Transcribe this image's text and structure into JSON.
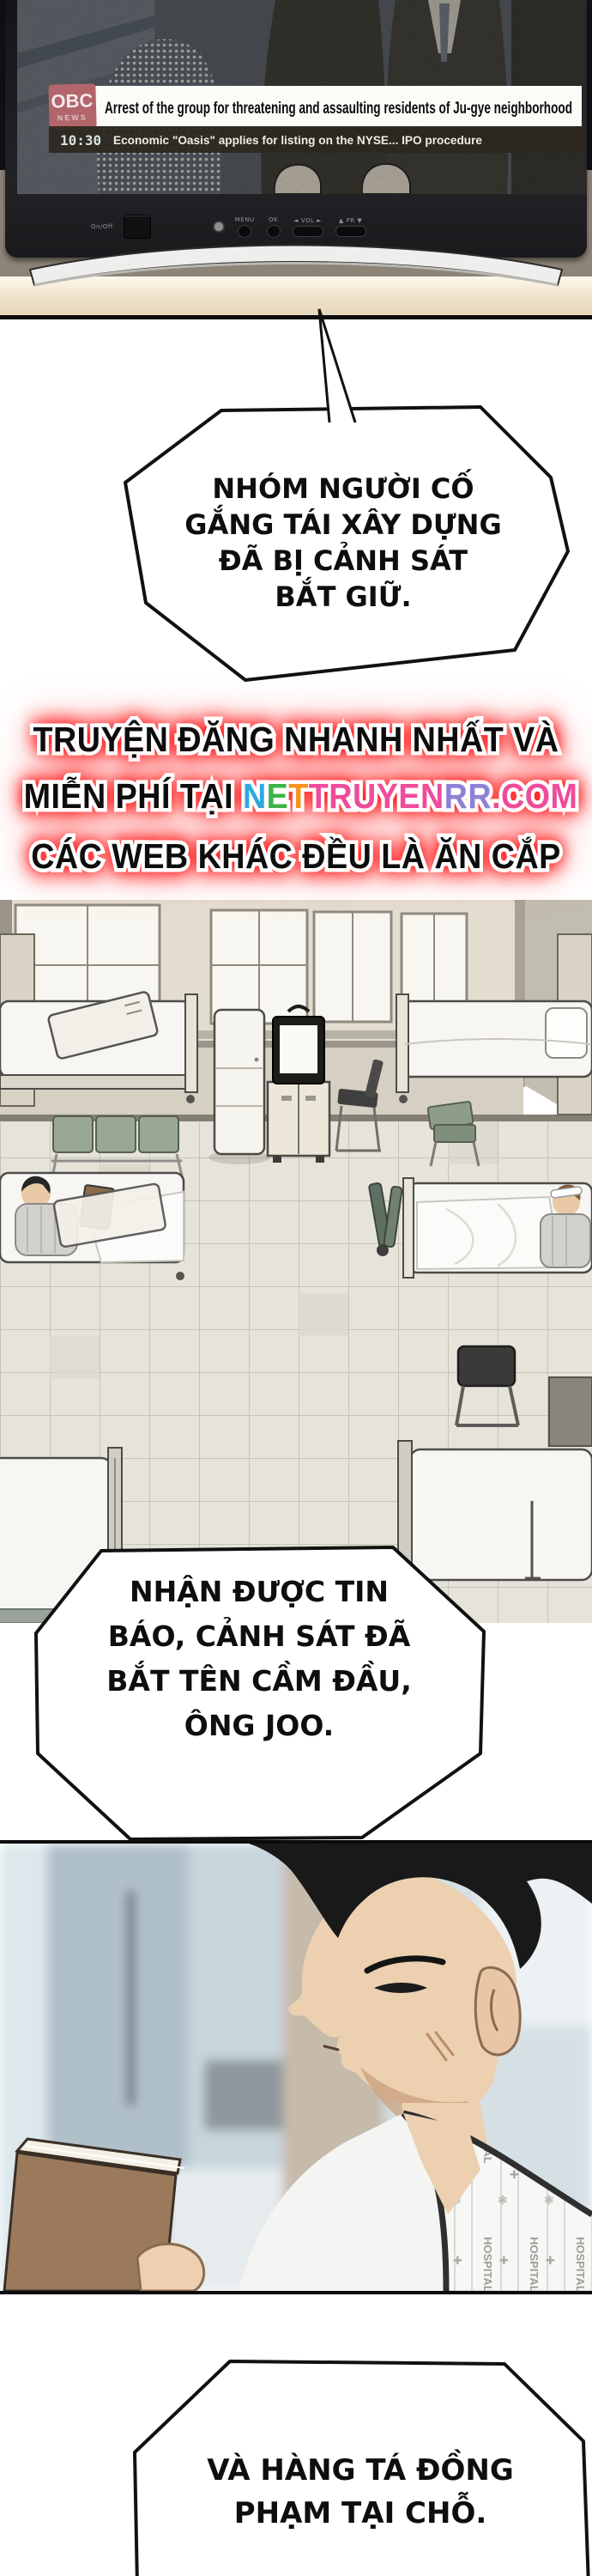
{
  "colors": {
    "glow_red": "#f20000",
    "obc_logo_red": "#b2656b",
    "bench_green": "#9aa795",
    "page_bg": "#ffffff"
  },
  "tv_panel": {
    "logo_text": "OBC",
    "logo_subtext": "NEWS",
    "time": "10:30",
    "headline": "Arrest of the group for threatening and assaulting residents of Ju-gye neighborhood",
    "ticker": "Economic \"Oasis\" applies for listing on the NYSE... IPO procedure",
    "controls": {
      "power": "On/Off",
      "menu": "MENU",
      "ok": "OK",
      "volume": "◄ VOL ►",
      "program": "▲ PR ▼"
    }
  },
  "bubbles": {
    "b1": {
      "lines": [
        "NHÓM NGƯỜI CỐ",
        "GẮNG TÁI XÂY DỰNG",
        "ĐÃ BỊ CẢNH SÁT",
        "BẮT GIỮ."
      ]
    },
    "b2": {
      "lines": [
        "NHẬN ĐƯỢC TIN",
        "BÁO, CẢNH SÁT ĐÃ",
        "BẮT TÊN CẦM ĐẦU,",
        "ÔNG JOO."
      ]
    },
    "b3": {
      "lines": [
        "VÀ HÀNG TÁ ĐỒNG",
        "PHẠM TẠI CHỖ."
      ]
    }
  },
  "promo": {
    "line_1": "TRUYỆN ĐĂNG NHANH NHẤT VÀ",
    "line_2_prefix": "MIỄN PHÍ TẠI ",
    "site_letters": [
      {
        "ch": "N",
        "color": "#2fa8e1"
      },
      {
        "ch": "E",
        "color": "#3cb54a"
      },
      {
        "ch": "T",
        "color": "#f7941d"
      },
      {
        "ch": "T",
        "color": "#ee4d9b"
      },
      {
        "ch": "R",
        "color": "#ee4d9b"
      },
      {
        "ch": "U",
        "color": "#ee4d9b"
      },
      {
        "ch": "Y",
        "color": "#ee4d9b"
      },
      {
        "ch": "E",
        "color": "#ee4d9b"
      },
      {
        "ch": "N",
        "color": "#ee4d9b"
      },
      {
        "ch": "R",
        "color": "#8d82d8"
      },
      {
        "ch": "R",
        "color": "#8d82d8"
      },
      {
        "ch": ".",
        "color": "#ee4d9b"
      },
      {
        "ch": "C",
        "color": "#ee4d9b"
      },
      {
        "ch": "O",
        "color": "#ee4d9b"
      },
      {
        "ch": "M",
        "color": "#ee4d9b"
      }
    ],
    "line_3": "CÁC WEB KHÁC ĐỀU LÀ ĂN CẮP"
  },
  "gown_pattern_text": "HOSPITAL"
}
